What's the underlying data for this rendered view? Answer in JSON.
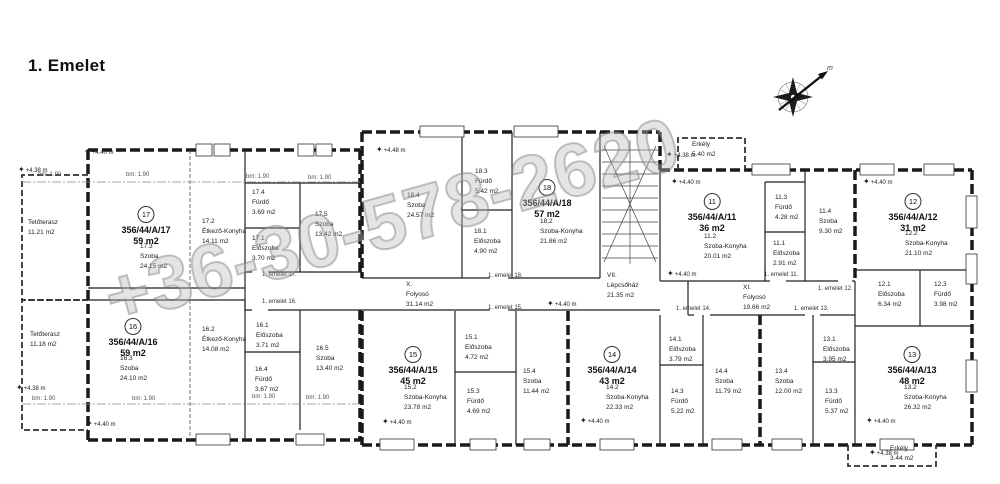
{
  "title": "1. Emelet",
  "watermark": "+36-30-578-2620",
  "compass": {
    "label": "m"
  },
  "labels": {
    "bm": "bm: 1.90"
  },
  "stairwell": {
    "id": "VII.",
    "name": "Lépcsőház",
    "area": "21.35 m2"
  },
  "corridor_x": {
    "id": "X.",
    "name": "Folyosó",
    "area": "31.14 m2"
  },
  "corridor_xi": {
    "id": "XI.",
    "name": "Folyosó",
    "area": "19.66 m2"
  },
  "terrace_top": {
    "name": "Tetőterasz",
    "area": "11.21 m2"
  },
  "terrace_bottom": {
    "name": "Tetőterasz",
    "area": "11.18 m2"
  },
  "balcony_top": {
    "name": "Erkély",
    "area": "5.40 m2"
  },
  "balcony_bottom": {
    "name": "Erkély",
    "area": "3.44 m2"
  },
  "apartments": [
    {
      "num": "17",
      "code": "356/44/A/17",
      "area": "59 m2",
      "rooms": [
        {
          "id": "17.3",
          "name": "Szoba",
          "area": "24.15 m2"
        },
        {
          "id": "17.2",
          "name": "Étkező-Konyha",
          "area": "14.11 m2"
        },
        {
          "id": "17.4",
          "name": "Fürdő",
          "area": "3.69 m2"
        },
        {
          "id": "17.1",
          "name": "Előszoba",
          "area": "3.70 m2"
        },
        {
          "id": "17.5",
          "name": "Szoba",
          "area": "13.42 m2"
        }
      ]
    },
    {
      "num": "16",
      "code": "356/44/A/16",
      "area": "59 m2",
      "rooms": [
        {
          "id": "16.3",
          "name": "Szoba",
          "area": "24.10 m2"
        },
        {
          "id": "16.2",
          "name": "Étkező-Konyha",
          "area": "14.08 m2"
        },
        {
          "id": "16.1",
          "name": "Előszoba",
          "area": "3.71 m2"
        },
        {
          "id": "16.4",
          "name": "Fürdő",
          "area": "3.67 m2"
        },
        {
          "id": "16.5",
          "name": "Szoba",
          "area": "13.40 m2"
        }
      ]
    },
    {
      "num": "18",
      "code": "356/44/A/18",
      "area": "57 m2",
      "rooms": [
        {
          "id": "18.4",
          "name": "Szoba",
          "area": "24.57 m2"
        },
        {
          "id": "18.3",
          "name": "Fürdő",
          "area": "5.42 m2"
        },
        {
          "id": "18.1",
          "name": "Előszoba",
          "area": "4.90 m2"
        },
        {
          "id": "18.2",
          "name": "Szoba-Konyha",
          "area": "21.86 m2"
        }
      ]
    },
    {
      "num": "11",
      "code": "356/44/A/11",
      "area": "36 m2",
      "rooms": [
        {
          "id": "11.2",
          "name": "Szoba-Konyha",
          "area": "20.01 m2"
        },
        {
          "id": "11.3",
          "name": "Fürdő",
          "area": "4.28 m2"
        },
        {
          "id": "11.1",
          "name": "Előszoba",
          "area": "2.91 m2"
        },
        {
          "id": "11.4",
          "name": "Szoba",
          "area": "9.30 m2"
        }
      ]
    },
    {
      "num": "12",
      "code": "356/44/A/12",
      "area": "31 m2",
      "rooms": [
        {
          "id": "12.2",
          "name": "Szoba-Konyha",
          "area": "21.10 m2"
        },
        {
          "id": "12.1",
          "name": "Előszoba",
          "area": "6.34 m2"
        },
        {
          "id": "12.3",
          "name": "Fürdő",
          "area": "3.98 m2"
        }
      ]
    },
    {
      "num": "15",
      "code": "356/44/A/15",
      "area": "45 m2",
      "rooms": [
        {
          "id": "15.2",
          "name": "Szoba-Konyha",
          "area": "23.78 m2"
        },
        {
          "id": "15.1",
          "name": "Előszoba",
          "area": "4.72 m2"
        },
        {
          "id": "15.3",
          "name": "Fürdő",
          "area": "4.69 m2"
        },
        {
          "id": "15.4",
          "name": "Szoba",
          "area": "11.44 m2"
        }
      ]
    },
    {
      "num": "14",
      "code": "356/44/A/14",
      "area": "43 m2",
      "rooms": [
        {
          "id": "14.2",
          "name": "Szoba-Konyha",
          "area": "22.33 m2"
        },
        {
          "id": "14.1",
          "name": "Előszoba",
          "area": "3.79 m2"
        },
        {
          "id": "14.3",
          "name": "Fürdő",
          "area": "5.22 m2"
        },
        {
          "id": "14.4",
          "name": "Szoba",
          "area": "11.79 m2"
        }
      ]
    },
    {
      "num": "13",
      "code": "356/44/A/13",
      "area": "48 m2",
      "rooms": [
        {
          "id": "13.2",
          "name": "Szoba-Konyha",
          "area": "26.32 m2"
        },
        {
          "id": "13.1",
          "name": "Előszoba",
          "area": "3.95 m2"
        },
        {
          "id": "13.3",
          "name": "Fürdő",
          "area": "5.37 m2"
        },
        {
          "id": "13.4",
          "name": "Szoba",
          "area": "12.00 m2"
        }
      ]
    }
  ],
  "door_labels": [
    "1. emelet 17.",
    "1. emelet 16.",
    "1. emelet 18.",
    "1. emelet 15.",
    "1. emelet 11.",
    "1. emelet 12.",
    "1. emelet 14.",
    "1. emelet 13."
  ],
  "elevation_markers": [
    "+4.38 m",
    "+4.40 m",
    "+4.38 m",
    "+4.40 m",
    "+4.48 m",
    "+4.38 m",
    "+4.40 m",
    "+4.40 m",
    "+4.40 m",
    "+4.40 m",
    "+4.40 m",
    "+4.40 m",
    "+4.40 m",
    "+4.38 m"
  ]
}
